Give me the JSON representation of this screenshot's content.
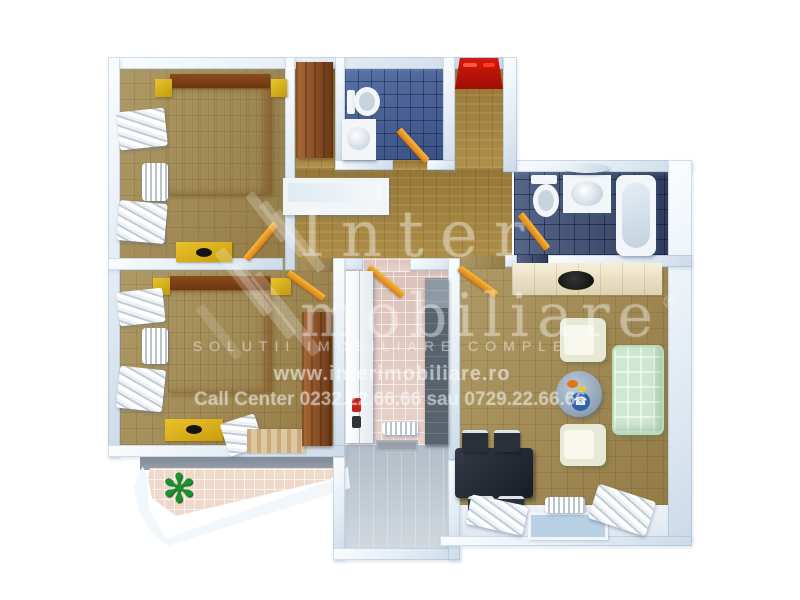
{
  "watermark": {
    "brand_top": "Inter",
    "brand_bottom": "mobiliare",
    "registered": "®",
    "tagline": "SOLUTII IMOBILIARE COMPLETE",
    "website": "www.interimobiliare.ro",
    "call_center": "Call Center 0232.22.66.66 sau 0729.22.66.66"
  },
  "decor": {
    "plant_glyph": "✻",
    "phone_glyph": "☎"
  },
  "rooms": [
    "bedroom-top-left",
    "bedroom-bottom-left",
    "small-bathroom",
    "large-bathroom",
    "entry-hall",
    "corridor",
    "interior-hall",
    "vestibule",
    "living-room",
    "kitchen-corner",
    "balcony"
  ],
  "colors": {
    "background": "#ffffff",
    "wall": "#e9f1f7",
    "bedroom_carpet": "#a2894f",
    "corridor_parquet": "#a8873f",
    "small_bath_tile": "#46629c",
    "large_bath_tile": "#3c4c70",
    "hall_tile": "#e6cdc3",
    "balcony_tile": "#eed9ca",
    "bed_orange": "#d4622a",
    "bed_yellow": "#e5d64f",
    "pillow_green": "#a9bc5c",
    "nightstand_yellow": "#dab41e",
    "wardrobe_wood": "#8d4a1c",
    "entry_door_red": "#c41408",
    "room_door_orange": "#e8961c",
    "sofa_green": "#cfe8d1",
    "dining_black": "#262b33",
    "plant_green": "#1d8f2e"
  }
}
